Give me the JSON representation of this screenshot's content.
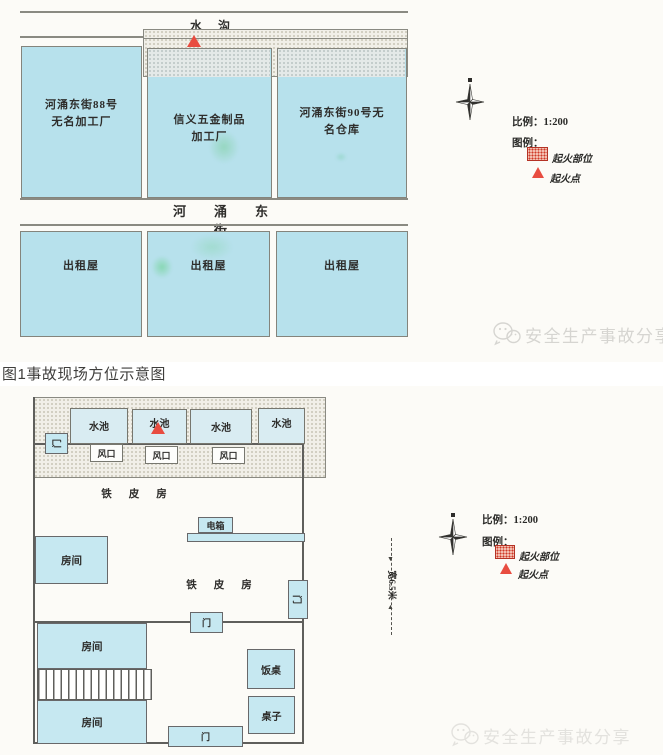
{
  "caption": "图1事故现场方位示意图",
  "watermark": {
    "brand": "安全生产事故分享"
  },
  "colors": {
    "fire_red": "#e84c40",
    "building_blue": "#b7e1ec",
    "room_blue": "#c6e8f1"
  },
  "site_plan": {
    "water_ditch": "水沟",
    "street": "河涌东街",
    "buildings": [
      {
        "lines": [
          "河涌东街88号",
          "无名加工厂"
        ]
      },
      {
        "lines": [
          "信义五金制品",
          "加工厂"
        ]
      },
      {
        "lines": [
          "河涌东街90号无",
          "名仓库"
        ]
      }
    ],
    "rental_houses": [
      "出租屋",
      "出租屋",
      "出租屋"
    ],
    "scale": "比例：1:200",
    "legend_title": "图例：",
    "legend": {
      "fire_area": "起火部位",
      "fire_point": "起火点"
    }
  },
  "floor_plan": {
    "pools": [
      "水池",
      "水池",
      "水池",
      "水池"
    ],
    "vents": [
      "风口",
      "风口",
      "风口"
    ],
    "doors": {
      "left": "门",
      "right": "门",
      "middle": "门",
      "bottom": "门"
    },
    "iron_sheet_house": "铁皮房",
    "electric_box": "电箱",
    "rooms": [
      "房间",
      "房间",
      "房间"
    ],
    "dining_table": "饭桌",
    "table": "桌子",
    "width_dimension": "宽6.5米",
    "scale": "比例：1:200",
    "legend_title": "图例：",
    "legend": {
      "fire_area": "起火部位",
      "fire_point": "起火点"
    }
  }
}
